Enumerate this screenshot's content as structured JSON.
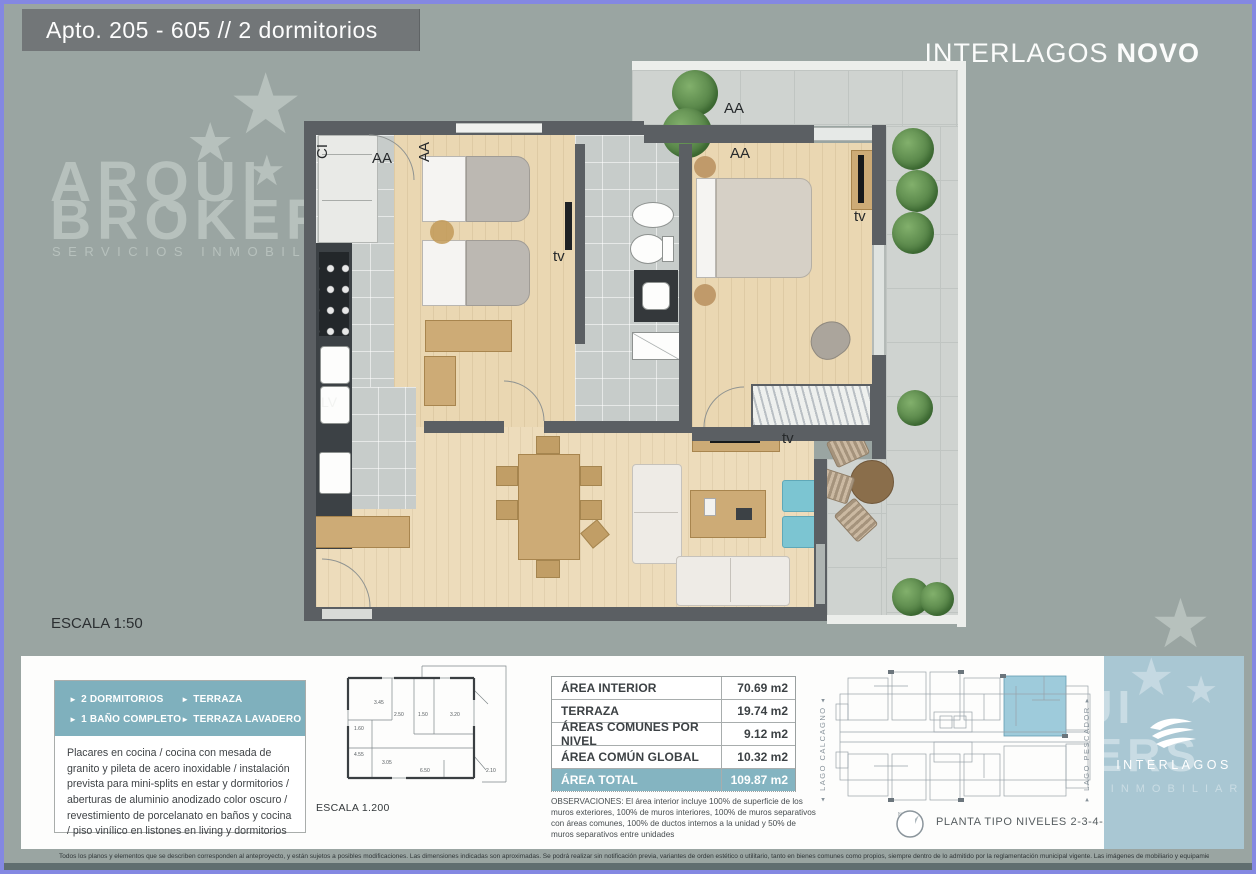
{
  "header": {
    "title": "Apto.  205 - 605 // 2 dormitorios"
  },
  "brand": {
    "name": "INTERLAGOS",
    "suffix": "NOVO"
  },
  "watermark": {
    "line1": "ARQUI",
    "line2": "BROKERS",
    "tagline": "SERVICIOS INMOBILIARIOS"
  },
  "floorplan": {
    "scale": "ESCALA 1:50",
    "labels": {
      "ci": "CI",
      "aa": "AA",
      "tv": "tv",
      "lv": "LV"
    }
  },
  "features": {
    "items": [
      "2 DORMITORIOS",
      "TERRAZA",
      "1 BAÑO COMPLETO",
      "TERRAZA LAVADERO"
    ],
    "description": "Placares en cocina / cocina con mesada de granito y pileta de acero inoxidable / instalación prevista para mini-splits en estar y dormitorios / aberturas de aluminio anodizado color oscuro / revestimiento de porcelanato en baños y cocina / piso vinílico en listones en living y dormitorios"
  },
  "miniplan": {
    "scale": "ESCALA 1.200",
    "dims": [
      "3.45",
      "2.50",
      "1.50",
      "3.20",
      "1.60",
      "4.55",
      "3.05",
      "6.50",
      "2.10"
    ]
  },
  "areas": {
    "rows": [
      {
        "label": "ÁREA INTERIOR",
        "value": "70.69 m2"
      },
      {
        "label": "TERRAZA",
        "value": "19.74 m2"
      },
      {
        "label": "ÁREAS COMUNES POR NIVEL",
        "value": "9.12 m2"
      },
      {
        "label": "ÁREA COMÚN GLOBAL",
        "value": "10.32 m2"
      }
    ],
    "total": {
      "label": "ÁREA TOTAL",
      "value": "109.87 m2"
    },
    "observations": "OBSERVACIONES: El área interior incluye 100% de superficie de los muros exteriores, 100% de muros interiores, 100% de muros separativos con áreas comunes, 100% de ductos internos a la unidad y 50% de muros separativos entre unidades"
  },
  "siteplan": {
    "left_label": "LAGO CALCAGNO",
    "right_label": "LAGO PESCADOR",
    "caption": "PLANTA TIPO NIVELES 2-3-4-5-6"
  },
  "footer": {
    "disclaimer": "Todos los planos y elementos que se describen corresponden al anteproyecto,  y están sujetos a posibles modificaciones. Las dimensiones indicadas son aproximadas. Se podrá realizar sin notificación previa, variantes de orden estético o utilitario, tanto en bienes comunes como propios, siempre dentro de lo admitido por la reglamentación municipal vigente. Las imágenes de mobiliario y equipamiento son de carácter ilustrativo."
  },
  "colors": {
    "page_bg": "#9aa5a2",
    "frame": "#8488e2",
    "title_bar": "#727678",
    "wall": "#5b5f63",
    "wood": "#ead7b2",
    "tile": "#c7ccca",
    "terrace": "#cfd3d0",
    "teal_header": "#7fb0bd",
    "teal_total": "#84b4c1",
    "unit_highlight": "#9ecbdb",
    "info_block": "#a9c7d3",
    "pouf": "#7cc5d2",
    "plant_green": "#557f46"
  }
}
